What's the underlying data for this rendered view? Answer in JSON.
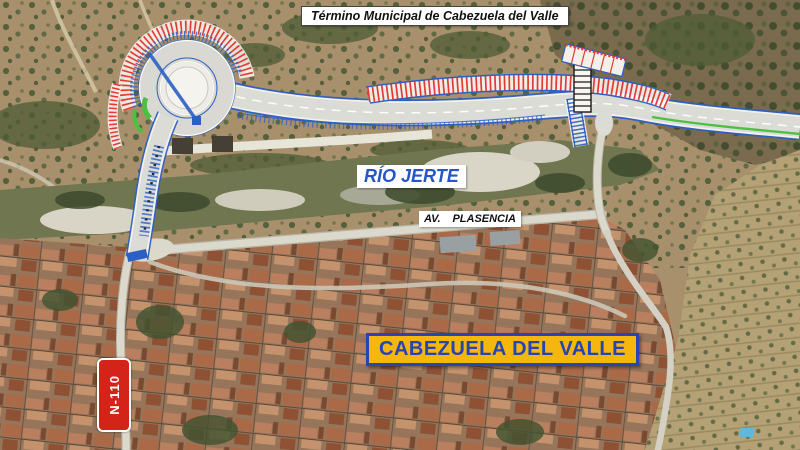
{
  "labels": {
    "municipal_boundary": "Término Municipal de Cabezuela del Valle",
    "river": "RÍO JERTE",
    "avenue_prefix": "AV.",
    "avenue_name": "PLASENCIA",
    "town": "CABEZUELA DEL VALLE",
    "road_sign": "N-110"
  },
  "colors": {
    "plan_blue": "#2b5fc4",
    "hatch_red": "#e23b32",
    "road_surface": "#dcdcd6",
    "green_edge": "#4cc040",
    "river_label_text": "#2456c8",
    "town_label_bg": "#f5b60e",
    "town_label_accent": "#2445b2",
    "sign_bg": "#d42318",
    "sign_text": "#ffffff",
    "label_bg": "#ffffff",
    "label_text": "#111111"
  }
}
